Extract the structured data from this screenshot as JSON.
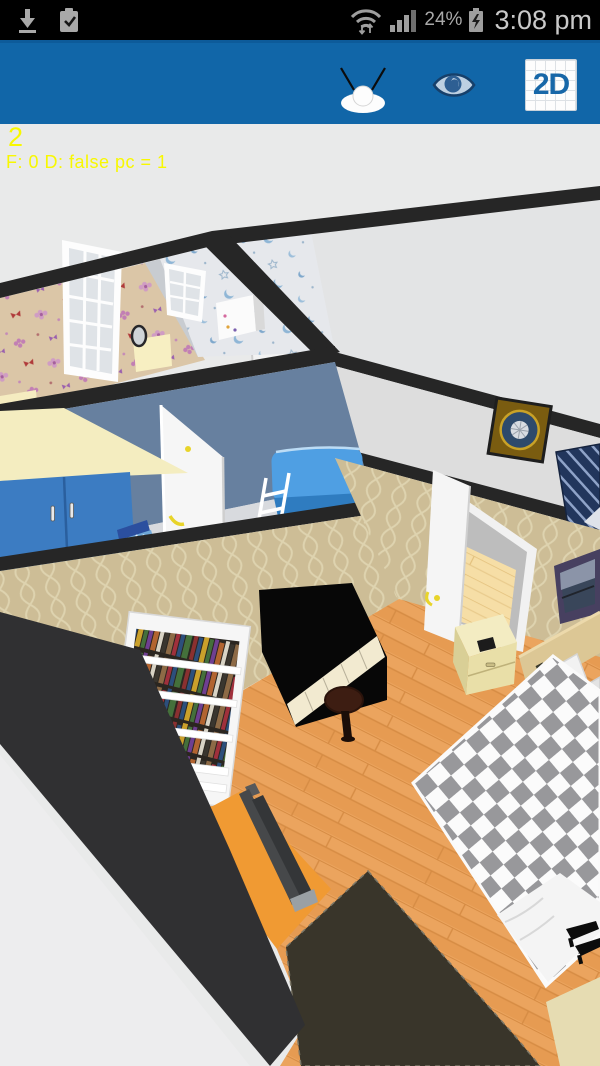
{
  "status_bar": {
    "time": "3:08 pm",
    "battery_percent": "24%",
    "battery_state": "charging",
    "wifi": "on",
    "signal_bars": 4,
    "background": "#000000",
    "icon_color": "#a9a9a9"
  },
  "toolbar": {
    "background": "#1166a8",
    "observer_button": "virtual-visitor-camera",
    "eye_button": "aerial-view-toggle",
    "button_2d_label": "2D"
  },
  "debug_overlay": {
    "line1": "2",
    "line2": "F: 0 D: false  pc = 1",
    "color": "#f8f800"
  },
  "scene": {
    "type": "3d-floorplan-aerial-view",
    "background": "#e9eaea",
    "wall_cut_color": "#262626",
    "rooms": [
      {
        "name": "kids-room-butterfly",
        "wallpaper": "tan with pink flowers and red butterflies",
        "wall_color": "#dbc6a7",
        "furniture": [
          "grid-window",
          "corner-desk",
          "round-mirror",
          "cream-desk"
        ]
      },
      {
        "name": "nursery-moon",
        "wallpaper": "white with blue crescent moons and stars",
        "wall_color": "#e6e8ec",
        "furniture": [
          "grid-window",
          "white-dresser"
        ]
      },
      {
        "name": "hallway",
        "wall_color": "#e3e4e5",
        "furniture": [
          "wall-clock-gold",
          "white-door",
          "navy-striped-unit"
        ]
      },
      {
        "name": "blue-bedroom",
        "wall_color": "#67809f",
        "floor_color": "#d8dade",
        "furniture": [
          "blue-wardrobe",
          "open-white-door",
          "blue-bunk-bed",
          "white-ladder",
          "pet-bed"
        ]
      },
      {
        "name": "master-bedroom",
        "wallpaper": "beige ogee wave pattern",
        "wall_color": "#cdbd96",
        "floor": "orange wood planks #eba45e",
        "furniture": [
          "white-bookshelf",
          "black-upright-piano",
          "piano-stool",
          "double-bed-checkered",
          "pillows",
          "headboard",
          "nightstand",
          "wall-picture",
          "tv-on-orange-mat",
          "dark-rug",
          "high-heel-shoes",
          "open-door"
        ]
      }
    ],
    "accent_colors": {
      "wardrobe_blue": "#3c7cc2",
      "bunk_blue": "#4f9fe3",
      "wood_floor": "#eba45e",
      "checker_gray": "#98989b",
      "rug_dark": "#39352a",
      "mat_orange": "#f09a33"
    }
  }
}
